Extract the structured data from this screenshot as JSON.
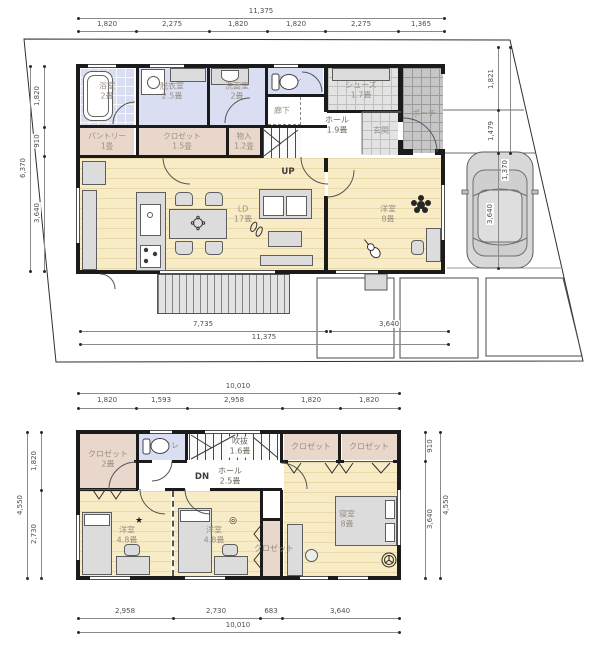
{
  "floor1": {
    "dims": {
      "top_total": "11,375",
      "top_segments": [
        "1,820",
        "2,275",
        "1,820",
        "1,820",
        "2,275",
        "1,365"
      ],
      "left_total": "6,370",
      "left_segments": [
        "1,820",
        "910",
        "3,640"
      ],
      "bottom_segments": [
        "7,735",
        "3,640"
      ],
      "bottom_total": "11,375",
      "right_segments": [
        "1,821",
        "1,479"
      ],
      "parking_segments": [
        "1,370",
        "3,640"
      ]
    },
    "rooms": {
      "bath": {
        "name": "浴室",
        "size": "2畳"
      },
      "dressing": {
        "name": "脱衣室",
        "size": "2.5畳"
      },
      "lavatory": {
        "name": "洗面室",
        "size": "2畳"
      },
      "toilet": {
        "name": "トイレ"
      },
      "corridor": {
        "name": "廊下"
      },
      "pantry": {
        "name": "パントリー",
        "size": "1畳"
      },
      "closet": {
        "name": "クロゼット",
        "size": "1.5畳"
      },
      "storage": {
        "name": "物入",
        "size": "1.2畳"
      },
      "hall": {
        "name": "ホール",
        "size": "1.9畳"
      },
      "entry": {
        "name": "玄関"
      },
      "shoes": {
        "name": "シューズ",
        "size": "1.7畳"
      },
      "porch": {
        "name": "ポーチ"
      },
      "living": {
        "name": "LD",
        "size": "17畳"
      },
      "western": {
        "name": "洋室",
        "size": "8畳"
      }
    },
    "stair_label": "UP"
  },
  "floor2": {
    "dims": {
      "top_total": "10,010",
      "top_segments": [
        "1,820",
        "1,593",
        "2,958",
        "1,820",
        "1,820"
      ],
      "left_total": "4,550",
      "left_segments": [
        "1,820",
        "2,730"
      ],
      "right_total": "4,550",
      "right_segments": [
        "910",
        "3,640"
      ],
      "bottom_segments": [
        "2,958",
        "2,730",
        "683",
        "3,640"
      ],
      "bottom_total": "10,010"
    },
    "rooms": {
      "closet_a": {
        "name": "クロゼット",
        "size": "2畳"
      },
      "toilet": {
        "name": "トイレ"
      },
      "void": {
        "name": "吹抜",
        "size": "1.6畳"
      },
      "hall": {
        "name": "ホール",
        "size": "2.5畳"
      },
      "closet_b": {
        "name": "クロゼット"
      },
      "closet_c": {
        "name": "クロゼット"
      },
      "bedroom": {
        "name": "寝室",
        "size": "8畳"
      },
      "western_a": {
        "name": "洋室",
        "size": "4.8畳"
      },
      "western_b": {
        "name": "洋室",
        "size": "4.8畳"
      },
      "closet_d": {
        "name": "クロゼット"
      }
    },
    "stair_label": "DN"
  },
  "icons": {
    "star": "★",
    "target": "◎"
  },
  "colors": {
    "wall": "#1b1b1b",
    "wood_floor": "#f8ecc6",
    "wet_room": "#d9def2",
    "closet_room": "#e9d7cc",
    "porch_tile": "#c6c6c6",
    "entry_tile": "#e3e3e3",
    "dim_text": "#4e4e4e",
    "room_label": "#988f81"
  }
}
